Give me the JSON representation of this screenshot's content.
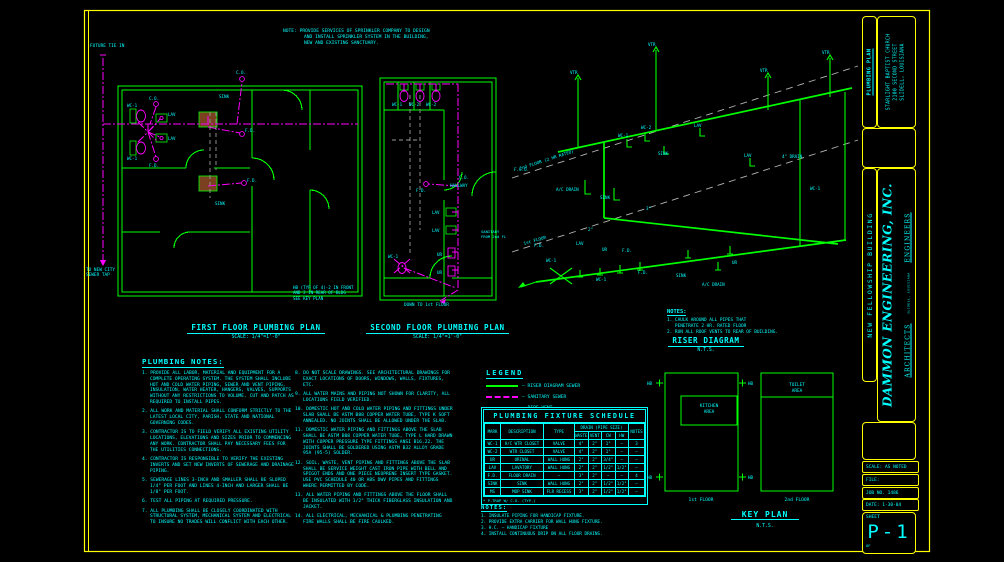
{
  "sheet": {
    "background": "#000000",
    "border_color": "#ffff00",
    "wall_color": "#00ff00",
    "sanitary_color": "#ff00ff",
    "vent_color": "#9a9a9a",
    "text_color": "#00ffff"
  },
  "top_note": {
    "lines": [
      "NOTE: PROVIDE SERVICES OF SPRINKLER COMPANY TO DESIGN",
      "AND INSTALL SPRINKLER SYSTEM IN THE BUILDING,",
      "NEW AND EXISTING SANCTUARY."
    ]
  },
  "plan_titles": {
    "first": {
      "title": "FIRST FLOOR PLUMBING PLAN",
      "scale": "SCALE: 1/4\"=1'-0\""
    },
    "second": {
      "title": "SECOND FLOOR PLUMBING PLAN",
      "scale": "SCALE: 1/4\"=1'-0\""
    }
  },
  "hb_note": {
    "lines": [
      "HB (TYP OF 4)-2 IN FRONT",
      "AND 2 IN REAR OF BLDG",
      "SEE KEY PLAN"
    ]
  },
  "riser": {
    "title": "RISER DIAGRAM",
    "scale": "N.T.S.",
    "notes_title": "NOTES:",
    "notes": [
      "1. CAULK AROUND ALL PIPES THAT",
      "   PENETRATE 2 HR. RATED FLOOR",
      "2. RUN ALL ROOF VENTS TO REAR OF BUILDING."
    ],
    "floor2_label": "2nd FLOOR (2 HR RATED)",
    "floor1_label": "1st FLOOR"
  },
  "labels": {
    "wc1": "WC-1",
    "wc2": "WC-2",
    "lav": "LAV",
    "ur": "UR",
    "fd": "F.D.",
    "co": "C.O.",
    "fco": "F.C.O.",
    "sink": "SINK",
    "vtr": "VTR",
    "hb": "HB",
    "ac_drain": "A/C DRAIN",
    "drain4": "4\" DRAIN",
    "size2": "2\"",
    "size3": "3\"",
    "future_tie_in": "FUTURE TIE IN",
    "to_city_sewer_1": "TO NEW CITY",
    "to_city_sewer_2": "SEWER TAP",
    "down_to_first": "DOWN TO 1st FLOOR",
    "hallway": "HALLWAY",
    "sanitary_1": "SANITARY",
    "sanitary_2": "FROM 2nd FL"
  },
  "plumbing_notes": {
    "title": "PLUMBING NOTES:",
    "column1": [
      "1. PROVIDE ALL LABOR, MATERIAL AND EQUIPMENT FOR A COMPLETE OPERATING SYSTEM. THE SYSTEM SHALL INCLUDE HOT AND COLD WATER PIPING, SEWER AND VENT PIPING, INSULATION, WATER HEATER, HANGERS, VALVES, SUPPORTS WITHOUT ANY RESTRICTIONS TO VOLUME. CUT AND PATCH AS REQUIRED TO INSTALL PIPES.",
      "2. ALL WORK AND MATERIAL SHALL CONFORM STRICTLY TO THE LATEST LOCAL CITY, PARISH, STATE AND NATIONAL GOVERNING CODES.",
      "3. CONTRACTOR IS TO FIELD VERIFY ALL EXISTING UTILITY LOCATIONS, ELEVATIONS AND SIZES PRIOR TO COMMENCING ANY WORK. CONTRACTOR SHALL PAY NECESSARY FEES FOR THE UTILITIES CONNECTIONS.",
      "4. CONTRACTOR IS RESPONSIBLE TO VERIFY THE EXISTING INVERTS AND SET NEW INVERTS OF SEWERAGE AND DRAINAGE PIPING.",
      "5. SEWERAGE LINES 3-INCH AND SMALLER SHALL BE SLOPED 1/4\" PER FOOT AND LINES 4-INCH AND LARGER SHALL BE 1/8\" PER FOOT.",
      "6. TEST ALL PIPING AT REQUIRED PRESSURE.",
      "7. ALL PLUMBING SHALL BE CLOSELY COORDINATED WITH STRUCTURAL SYSTEM, MECHANICAL SYSTEM AND ELECTRICAL TO INSURE NO TRADES WILL CONFLICT WITH EACH OTHER."
    ],
    "column2": [
      "8. DO NOT SCALE DRAWINGS. SEE ARCHITECTURAL DRAWINGS FOR EXACT LOCATIONS OF DOORS, WINDOWS, WALLS, FIXTURES, ETC.",
      "9. ALL WATER MAINS AND PIPING NOT SHOWN FOR CLARITY, ALL LOCATIONS FIELD VERIFIED.",
      "10. DOMESTIC HOT AND COLD WATER PIPING AND FITTINGS UNDER SLAB SHALL BE ASTM B88 COPPER WATER TUBE, TYPE K SOFT ANNEALED. NO JOINTS SHALL BE ALLOWED UNDER THE SLAB.",
      "11. DOMESTIC WATER PIPING AND FITTINGS ABOVE THE SLAB SHALL BE ASTM B88 COPPER WATER TUBE, TYPE L HARD DRAWN WITH COPPER PRESSURE TYPE FITTINGS ANSI B16.22. THE JOINTS SHALL BE SOLDERED USING ASTM B32 ALLOY GRADE 95A (95-5) SOLDER.",
      "12. SOIL, WASTE, VENT PIPING AND FITTINGS ABOVE THE SLAB SHALL BE SERVICE WEIGHT CAST IRON PIPE WITH BELL AND SPIGOT ENDS AND ONE PIECE NEOPRENE INSERT TYPE GASKET. USE PVC SCHEDULE 40 OR ABS DWV PIPES AND FITTINGS WHERE PERMITTED BY CODE.",
      "13. ALL WATER PIPING AND FITTINGS ABOVE THE FLOOR SHALL BE INSULATED WITH 1/2\" THICK FIBERGLASS INSULATION AND JACKET.",
      "14. ALL ELECTRICAL, MECHANICAL & PLUMBING PENETRATING FIRE WALLS SHALL BE FIRE CAULKED."
    ]
  },
  "legend": {
    "title": "LEGEND",
    "items": [
      {
        "label": "RISER DIAGRAM SEWER",
        "color": "#00ff00",
        "style": "solid"
      },
      {
        "label": "SANITARY SEWER",
        "color": "#ff00ff",
        "style": "dashed"
      },
      {
        "label": "PIPE VENT",
        "color": "#9a9a9a",
        "style": "dashed"
      }
    ]
  },
  "schedule": {
    "title": "PLUMBING FIXTURE SCHEDULE",
    "col_headers": [
      "MARK",
      "DESCRIPTION",
      "TYPE"
    ],
    "pipe_group_header": "DRAIN (PIPE SIZE)",
    "pipe_headers": [
      "WASTE",
      "VENT",
      "CW",
      "HW"
    ],
    "notes_header": "NOTES",
    "rows": [
      [
        "WC-1",
        "H/C WTR CLOSET",
        "VALVE",
        "4\"",
        "2\"",
        "1\"",
        "—",
        "3"
      ],
      [
        "WC-2",
        "WTR CLOSET",
        "VALVE",
        "4\"",
        "2\"",
        "1\"",
        "—",
        "—"
      ],
      [
        "UR",
        "URINAL",
        "WALL HUNG",
        "2\"",
        "2\"",
        "3/4\"",
        "—",
        "—"
      ],
      [
        "LAV",
        "LAVATORY",
        "WALL HUNG",
        "2\"",
        "2\"",
        "1/2\"",
        "1/2\"",
        "—"
      ],
      [
        "F.D.",
        "FLOOR DRAIN",
        "—",
        "3\"",
        "2\"",
        "—",
        "—",
        "4"
      ],
      [
        "SINK",
        "SINK",
        "WALL HUNG",
        "2\"",
        "2\"",
        "1/2\"",
        "1/2\"",
        "—"
      ],
      [
        "MS",
        "MOP SINK",
        "FLR RECESS",
        "3\"",
        "2\"",
        "1/2\"",
        "1/2\"",
        "—"
      ]
    ],
    "footnote": "* P-TRAP W/ C.O. (TYP.)"
  },
  "schedule_notes": {
    "title": "NOTES:",
    "items": [
      "1. INSULATE PIPING FOR HANDICAP FIXTURE.",
      "2. PROVIDE EXTRA CARRIER FOR WALL HUNG FIXTURE.",
      "3. H.C. — HANDICAP FIXTURE",
      "4. INSTALL CONTINUOUS DRIP ON ALL FLOOR DRAINS."
    ]
  },
  "key_plan": {
    "title": "KEY PLAN",
    "scale": "N.T.S.",
    "kitchen_line1": "KITCHEN",
    "kitchen_line2": "AREA",
    "toilet_line1": "TOILET",
    "toilet_line2": "AREA",
    "floor1": "1st FLOOR",
    "floor2": "2nd FLOOR"
  },
  "title_block": {
    "sheet_title": "PLUMBING PLAN",
    "project_line1": "STARLIGHT BAPTIST CHURCH",
    "project_line2": "2100 SECOND STREET",
    "project_line3": "SLIDELL, LOUISIANA",
    "building": "NEW FELLOWSHIP BUILDING",
    "firm_name": "DAMMON ENGINEERING, INC.",
    "firm_type_1": "ARCHITECTS",
    "firm_type_2": "ENGINEERS",
    "firm_address": "SLIDELL, LOUISIANA",
    "scale_label": "SCALE: AS NOTED",
    "file_label": "FILE:",
    "job_label": "JOB NO. 1486",
    "date_label": "DATE: 1-30-04",
    "sheet_label": "SHEET",
    "sheet_number": "P-1",
    "of_label": "OF"
  }
}
